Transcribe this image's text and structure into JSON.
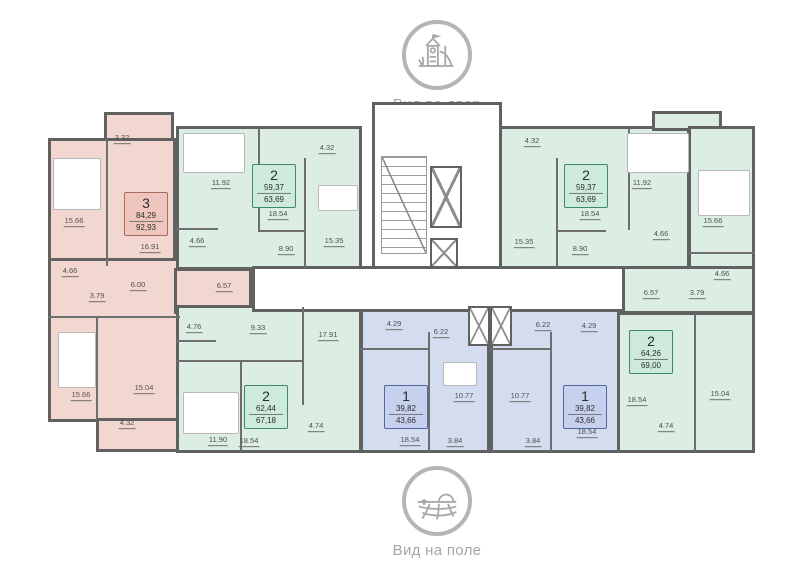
{
  "view_top": {
    "icon": "playground-icon",
    "label": "Вид во двор"
  },
  "view_bottom": {
    "icon": "field-icon",
    "label": "Вид на поле"
  },
  "colors": {
    "wall": "#616161",
    "pink": "#f2d7d0",
    "pink_badge": "#eec6bd",
    "pink_border": "#a96a60",
    "green": "#dceee4",
    "green_badge": "#cdeadc",
    "green_border": "#3c8a68",
    "blue": "#d4ddf0",
    "blue_badge": "#c6d1ed",
    "blue_border": "#5268a2"
  },
  "apartments": [
    {
      "name": "3-room-left",
      "color_key": "pink",
      "badge": {
        "rooms": "3",
        "area1": "84,29",
        "area2": "92,93",
        "cx": 146,
        "cy": 214
      },
      "labels": [
        {
          "t": "3.32",
          "x": 122,
          "y": 139
        },
        {
          "t": "15.66",
          "x": 74,
          "y": 222
        },
        {
          "t": "16.91",
          "x": 150,
          "y": 248
        },
        {
          "t": "4.66",
          "x": 70,
          "y": 272
        },
        {
          "t": "3.79",
          "x": 97,
          "y": 297
        },
        {
          "t": "6.00",
          "x": 138,
          "y": 286
        },
        {
          "t": "6.57",
          "x": 224,
          "y": 287
        },
        {
          "t": "15.66",
          "x": 81,
          "y": 396
        },
        {
          "t": "15.04",
          "x": 144,
          "y": 389
        },
        {
          "t": "4.32",
          "x": 127,
          "y": 424
        }
      ]
    },
    {
      "name": "2-room-top-left",
      "color_key": "green",
      "badge": {
        "rooms": "2",
        "area1": "59,37",
        "area2": "63,69",
        "cx": 274,
        "cy": 186
      },
      "labels": [
        {
          "t": "11.92",
          "x": 221,
          "y": 184
        },
        {
          "t": "4.32",
          "x": 327,
          "y": 149
        },
        {
          "t": "18.54",
          "x": 278,
          "y": 215
        },
        {
          "t": "4.66",
          "x": 197,
          "y": 242
        },
        {
          "t": "15.35",
          "x": 334,
          "y": 242
        },
        {
          "t": "8.90",
          "x": 286,
          "y": 250
        }
      ]
    },
    {
      "name": "2-room-top-right",
      "color_key": "green",
      "badge": {
        "rooms": "2",
        "area1": "59,37",
        "area2": "63,69",
        "cx": 586,
        "cy": 186
      },
      "labels": [
        {
          "t": "4.32",
          "x": 532,
          "y": 142
        },
        {
          "t": "18.54",
          "x": 590,
          "y": 215
        },
        {
          "t": "11.92",
          "x": 642,
          "y": 184
        },
        {
          "t": "15.35",
          "x": 524,
          "y": 243
        },
        {
          "t": "4.66",
          "x": 661,
          "y": 235
        },
        {
          "t": "8.90",
          "x": 580,
          "y": 250
        }
      ]
    },
    {
      "name": "2-room-right",
      "color_key": "green",
      "badge": {
        "rooms": "2",
        "area1": "64,26",
        "area2": "69,00",
        "cx": 651,
        "cy": 352
      },
      "labels": [
        {
          "t": "15.66",
          "x": 713,
          "y": 222
        },
        {
          "t": "4.66",
          "x": 722,
          "y": 275
        },
        {
          "t": "6.57",
          "x": 651,
          "y": 294
        },
        {
          "t": "3.79",
          "x": 697,
          "y": 294
        },
        {
          "t": "18.54",
          "x": 637,
          "y": 401
        },
        {
          "t": "15.04",
          "x": 720,
          "y": 395
        },
        {
          "t": "4.74",
          "x": 666,
          "y": 427
        }
      ]
    },
    {
      "name": "2-room-bottom-left",
      "color_key": "green",
      "badge": {
        "rooms": "2",
        "area1": "62,44",
        "area2": "67,18",
        "cx": 266,
        "cy": 407
      },
      "labels": [
        {
          "t": "4.76",
          "x": 194,
          "y": 328
        },
        {
          "t": "9.33",
          "x": 258,
          "y": 329
        },
        {
          "t": "17.91",
          "x": 328,
          "y": 336
        },
        {
          "t": "11.90",
          "x": 218,
          "y": 441
        },
        {
          "t": "18.54",
          "x": 249,
          "y": 442
        },
        {
          "t": "4.74",
          "x": 316,
          "y": 427
        }
      ]
    },
    {
      "name": "1-room-left",
      "color_key": "blue",
      "badge": {
        "rooms": "1",
        "area1": "39,82",
        "area2": "43,66",
        "cx": 406,
        "cy": 407
      },
      "labels": [
        {
          "t": "4.29",
          "x": 394,
          "y": 325
        },
        {
          "t": "6.22",
          "x": 441,
          "y": 333
        },
        {
          "t": "10.77",
          "x": 464,
          "y": 397
        },
        {
          "t": "18.54",
          "x": 410,
          "y": 441
        },
        {
          "t": "3.84",
          "x": 455,
          "y": 442
        }
      ]
    },
    {
      "name": "1-room-right",
      "color_key": "blue",
      "badge": {
        "rooms": "1",
        "area1": "39,82",
        "area2": "43,66",
        "cx": 585,
        "cy": 407
      },
      "labels": [
        {
          "t": "6.22",
          "x": 543,
          "y": 326
        },
        {
          "t": "4.29",
          "x": 589,
          "y": 327
        },
        {
          "t": "10.77",
          "x": 520,
          "y": 397
        },
        {
          "t": "18.54",
          "x": 587,
          "y": 433
        },
        {
          "t": "3.84",
          "x": 533,
          "y": 442
        }
      ]
    }
  ]
}
